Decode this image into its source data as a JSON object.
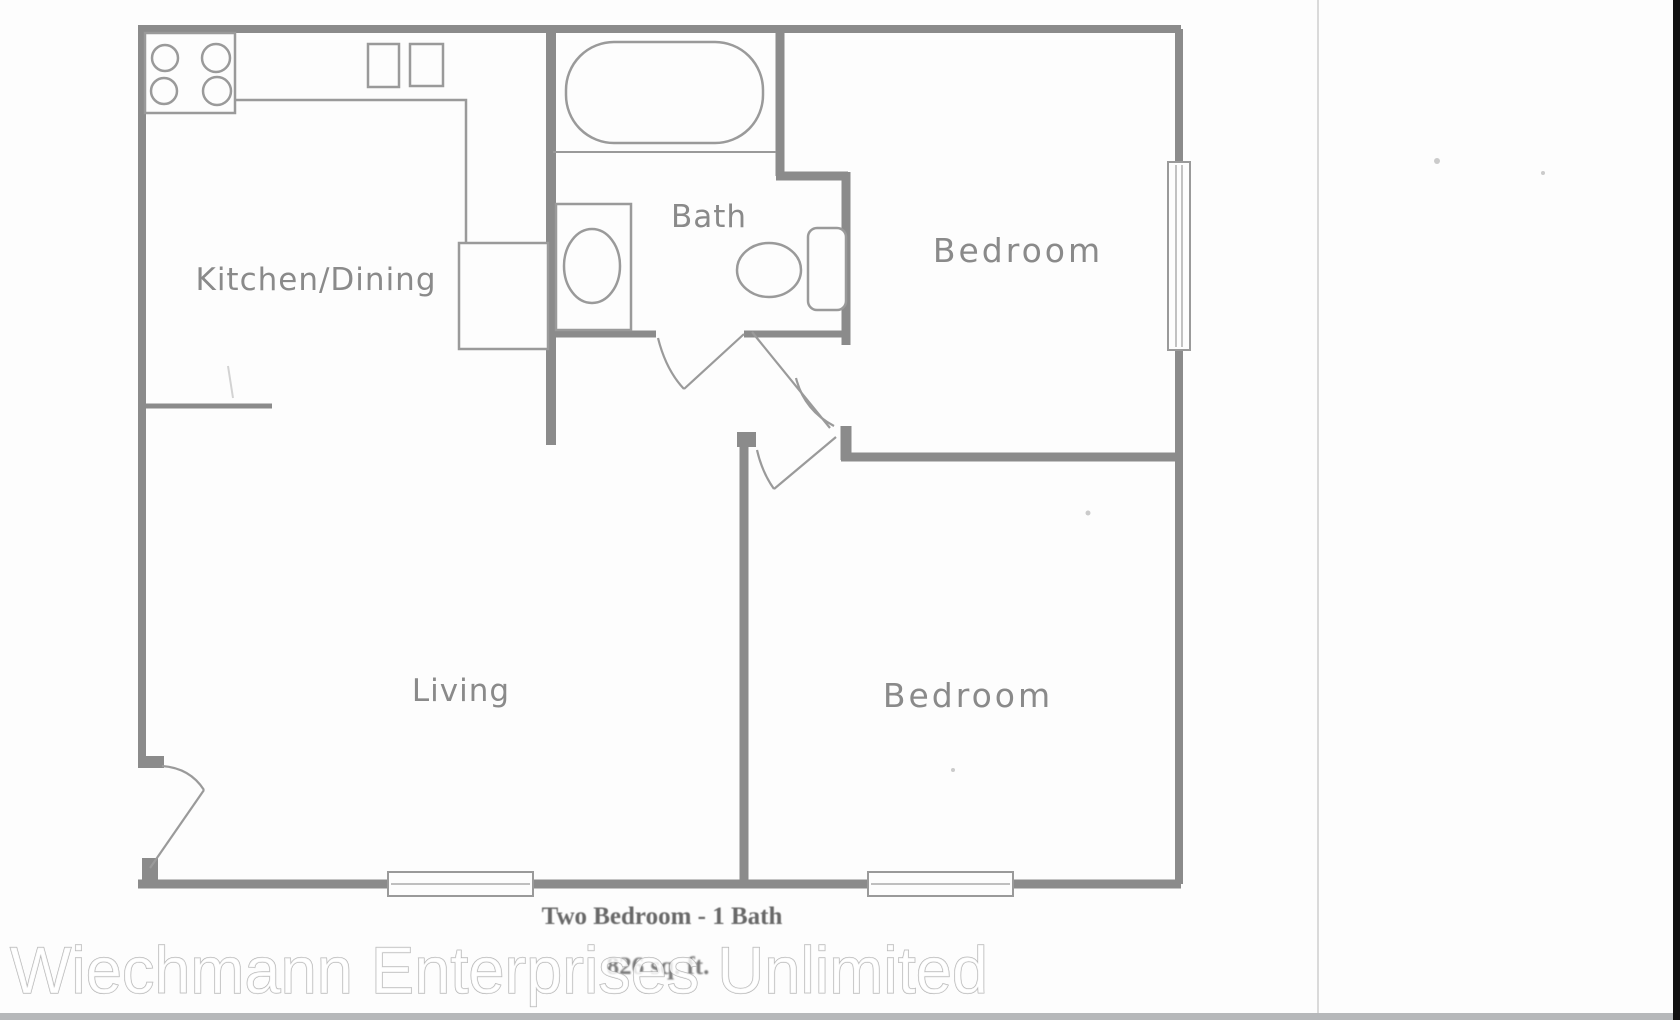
{
  "floor_plan": {
    "rooms": [
      {
        "id": "kitchen-dining",
        "label": "Kitchen/Dining"
      },
      {
        "id": "bath",
        "label": "Bath"
      },
      {
        "id": "bedroom-top",
        "label": "Bedroom"
      },
      {
        "id": "living",
        "label": "Living"
      },
      {
        "id": "bedroom-bottom",
        "label": "Bedroom"
      }
    ],
    "caption": {
      "title": "Two Bedroom - 1 Bath",
      "area": "826 sq. ft."
    },
    "fixtures": [
      "stove-icon",
      "burner-icon",
      "kitchen-counter",
      "pantry-cabinet",
      "double-sink-icon",
      "bathtub-icon",
      "bath-sink-icon",
      "toilet-icon",
      "vanity-cabinet-icon",
      "window-icon",
      "door-swing-icon"
    ]
  },
  "watermark": {
    "text": "Wiechmann Enterprises Unlimited",
    "fill_color": "#ffffff",
    "outline_color": "#b2b2b2"
  },
  "colors": {
    "wall": "#8b8b8b",
    "fixture_line": "#9a9a9a",
    "room_label": "#8a8a8a",
    "caption": "#686868",
    "page_background": "#fdfdfd",
    "divider_line": "#cfcfcf",
    "photo_right_edge": "#111111",
    "bottom_strip": "#b6b8ba"
  }
}
